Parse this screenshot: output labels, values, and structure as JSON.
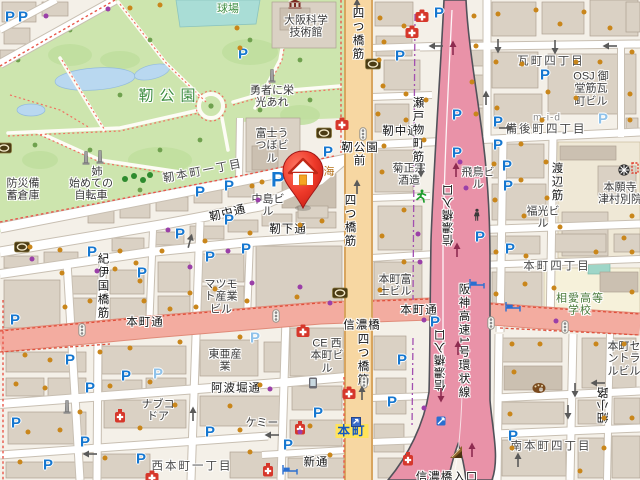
{
  "map": {
    "title": "靭公園周辺地図",
    "marker": {
      "x": 303,
      "y": 182,
      "label": "home"
    },
    "roads": {
      "arterial_ew": "本町通",
      "arterial_ns": "四つ橋筋",
      "expressway": "阪神高速1号環状線",
      "ramp": "信濃橋入口",
      "accent_pink": "#F3ACA0",
      "accent_yellow": "#F7D7A2",
      "accent_expwy": "#E992A8",
      "park_green": "#CDE5AE"
    },
    "labels": [
      {
        "n": "park-name",
        "t": "靭公園",
        "x": 170,
        "y": 97,
        "c": "pk"
      },
      {
        "n": "ballfield-label",
        "t": "球場",
        "x": 228,
        "y": 9,
        "c": "gn"
      },
      {
        "n": "museum-label",
        "t": "大阪科学\n技術館",
        "x": 306,
        "y": 27,
        "c": "bl"
      },
      {
        "n": "monument-label-yusha",
        "t": "勇者に栄\n光あれ",
        "x": 272,
        "y": 97,
        "c": "bl"
      },
      {
        "n": "monument-label-ane",
        "t": "姉",
        "x": 97,
        "y": 172,
        "c": "bl"
      },
      {
        "n": "monument-label-jitensha",
        "t": "始めての\n自転車",
        "x": 91,
        "y": 190,
        "c": "bl"
      },
      {
        "n": "bosai-label",
        "t": "防災備\n蓄倉庫",
        "x": 23,
        "y": 190,
        "c": "bl"
      },
      {
        "n": "district-utsubohonmachi",
        "t": "靭本町一丁目",
        "x": 203,
        "y": 172,
        "c": "dt",
        "r": -11
      },
      {
        "n": "bldg-fuji-utsubo",
        "t": "富士う\nつぼビ\nル",
        "x": 272,
        "y": 146,
        "c": "bl"
      },
      {
        "n": "street-utsubo-nakadori-w",
        "t": "靭中通",
        "x": 228,
        "y": 214,
        "c": "st",
        "r": -14
      },
      {
        "n": "street-utsubo-nakadori-e",
        "t": "靭中通",
        "x": 401,
        "y": 132,
        "c": "st"
      },
      {
        "n": "bldg-nakajima",
        "t": "中島ビ\nル",
        "x": 268,
        "y": 206,
        "c": "bl"
      },
      {
        "n": "street-utsubo-shimodori",
        "t": "靭下通",
        "x": 288,
        "y": 230,
        "c": "st"
      },
      {
        "n": "poi-partial-umi",
        "t": "海",
        "x": 329,
        "y": 172,
        "c": "or"
      },
      {
        "n": "intersection-utsubokoenmae",
        "t": "靭公園\n前",
        "x": 360,
        "y": 155,
        "c": "st"
      },
      {
        "n": "street-yotsubashisuji-top",
        "t": "四つ橋筋",
        "x": 357,
        "y": 34,
        "c": "st vert"
      },
      {
        "n": "street-yotsubashisuji-mid",
        "t": "四つ橋筋",
        "x": 349,
        "y": 221,
        "c": "st vert"
      },
      {
        "n": "street-yotsubashisuji-bot",
        "t": "四つ橋筋",
        "x": 362,
        "y": 360,
        "c": "st vert"
      },
      {
        "n": "bldg-matsumoto",
        "t": "マツモ\nト産業\nビル",
        "x": 221,
        "y": 297,
        "c": "bl"
      },
      {
        "n": "street-honmachidori-w",
        "t": "本町通",
        "x": 145,
        "y": 323,
        "c": "st"
      },
      {
        "n": "street-honmachidori-e",
        "t": "本町通",
        "x": 419,
        "y": 311,
        "c": "st"
      },
      {
        "n": "street-kiinokunibashisuji",
        "t": "紀伊国橋筋",
        "x": 102,
        "y": 286,
        "c": "st vert"
      },
      {
        "n": "bldg-toa",
        "t": "東亜産\n業",
        "x": 225,
        "y": 361,
        "c": "bl"
      },
      {
        "n": "street-awahoridori",
        "t": "阿波堀通",
        "x": 236,
        "y": 389,
        "c": "st"
      },
      {
        "n": "bldg-nabco",
        "t": "ナブコ\nドア",
        "x": 158,
        "y": 411,
        "c": "bl"
      },
      {
        "n": "bldg-chemi",
        "t": "ケミー",
        "x": 262,
        "y": 423,
        "c": "bl"
      },
      {
        "n": "district-nishihonmachi",
        "t": "西本町一丁目",
        "x": 192,
        "y": 467,
        "c": "dt"
      },
      {
        "n": "street-shintori",
        "t": "新通",
        "x": 316,
        "y": 463,
        "c": "st"
      },
      {
        "n": "bldg-kikumasamune",
        "t": "菊正宗\n酒造",
        "x": 409,
        "y": 175,
        "c": "bl"
      },
      {
        "n": "street-setomonocho-suji",
        "t": "瀬戸物町筋",
        "x": 417,
        "y": 130,
        "c": "st vert"
      },
      {
        "n": "bldg-asuka",
        "t": "飛鳥ビ\nル",
        "x": 478,
        "y": 179,
        "c": "bl"
      },
      {
        "n": "bldg-fukumitsu",
        "t": "福光ビ\nル",
        "x": 543,
        "y": 218,
        "c": "bl"
      },
      {
        "n": "district-kawaramachi",
        "t": "瓦町四丁目",
        "x": 551,
        "y": 62,
        "c": "dt"
      },
      {
        "n": "bldg-osj-midosuji",
        "t": "OSJ 御\n堂筋瓦\n町ビル",
        "x": 591,
        "y": 89,
        "c": "bl"
      },
      {
        "n": "bldg-mid",
        "t": "m-i-d",
        "x": 547,
        "y": 118,
        "c": "gy"
      },
      {
        "n": "district-bingomachi",
        "t": "備後町四丁目",
        "x": 546,
        "y": 130,
        "c": "dt"
      },
      {
        "n": "street-watanabesuji",
        "t": "渡辺筋",
        "x": 556,
        "y": 182,
        "c": "st vert"
      },
      {
        "n": "poi-honganji",
        "t": "本願寺\n津村別院",
        "x": 620,
        "y": 194,
        "c": "bl"
      },
      {
        "n": "district-honmachi4",
        "t": "本町四丁目",
        "x": 557,
        "y": 267,
        "c": "dt"
      },
      {
        "n": "school-soai",
        "t": "相愛高等\n学校",
        "x": 580,
        "y": 305,
        "c": "sc"
      },
      {
        "n": "intersection-shinanobashi",
        "t": "信濃橋",
        "x": 362,
        "y": 326,
        "c": "st"
      },
      {
        "n": "bldg-ce-nishihonmachi",
        "t": "CE 西\n本町ビ\nル",
        "x": 327,
        "y": 356,
        "c": "bl"
      },
      {
        "n": "bldg-honmachi-fuji",
        "t": "本町富\n士ビル",
        "x": 395,
        "y": 286,
        "c": "bl"
      },
      {
        "n": "expwy-hanshin-loop",
        "t": "阪神高速1号環状線",
        "x": 463,
        "y": 341,
        "c": "st vert"
      },
      {
        "n": "ramp-shinanobashi-1",
        "t": "信濃橋入口",
        "x": 449,
        "y": 215,
        "c": "st vrev"
      },
      {
        "n": "ramp-shinanobashi-2",
        "t": "信濃橋入口",
        "x": 441,
        "y": 360,
        "c": "st vrev"
      },
      {
        "n": "ramp-shinanobashi-3",
        "t": "信濃橋入口",
        "x": 447,
        "y": 478,
        "c": "st"
      },
      {
        "n": "station-honmachi",
        "t": "本町",
        "x": 352,
        "y": 431,
        "c": "sta"
      },
      {
        "n": "bldg-honmachi-central",
        "t": "本町セ\nントラ\nルビル",
        "x": 624,
        "y": 359,
        "c": "bl"
      },
      {
        "n": "district-minamihonmachi",
        "t": "南本町四丁目",
        "x": 551,
        "y": 447,
        "c": "dt"
      },
      {
        "n": "lane-hosokoji",
        "t": "細小路",
        "x": 604,
        "y": 405,
        "c": "st vrev"
      }
    ],
    "icons": {
      "parking": [
        [
          10,
          17
        ],
        [
          23,
          17
        ],
        [
          243,
          54
        ],
        [
          400,
          56
        ],
        [
          439,
          13
        ],
        [
          545,
          75
        ],
        [
          457,
          115
        ],
        [
          457,
          153
        ],
        [
          498,
          122
        ],
        [
          498,
          145
        ],
        [
          507,
          166
        ],
        [
          508,
          186
        ],
        [
          480,
          237
        ],
        [
          510,
          249
        ],
        [
          229,
          220
        ],
        [
          246,
          249
        ],
        [
          210,
          257
        ],
        [
          180,
          234
        ],
        [
          200,
          192
        ],
        [
          229,
          186
        ],
        [
          328,
          152
        ],
        [
          92,
          252
        ],
        [
          142,
          273
        ],
        [
          15,
          320
        ],
        [
          70,
          360
        ],
        [
          90,
          388
        ],
        [
          126,
          376
        ],
        [
          85,
          442
        ],
        [
          16,
          423
        ],
        [
          48,
          465
        ],
        [
          141,
          459
        ],
        [
          210,
          432
        ],
        [
          318,
          413
        ],
        [
          288,
          445
        ],
        [
          402,
          360
        ],
        [
          392,
          402
        ],
        [
          435,
          322
        ],
        [
          513,
          436
        ]
      ],
      "parking_light": [
        [
          603,
          119
        ],
        [
          158,
          374
        ],
        [
          255,
          338
        ]
      ],
      "parking_big": [
        [
          278,
          180
        ]
      ],
      "hospital": [
        [
          422,
          16
        ],
        [
          412,
          32
        ],
        [
          342,
          124
        ],
        [
          303,
          331
        ],
        [
          349,
          393
        ],
        [
          152,
          477
        ]
      ],
      "pharmacy": [
        [
          300,
          428
        ],
        [
          408,
          459
        ],
        [
          268,
          470
        ],
        [
          120,
          416
        ]
      ],
      "bank": [
        [
          22,
          247
        ],
        [
          324,
          133
        ],
        [
          373,
          64
        ],
        [
          340,
          293
        ],
        [
          4,
          148
        ]
      ],
      "monument": [
        [
          272,
          76
        ],
        [
          86,
          158
        ],
        [
          100,
          157
        ],
        [
          67,
          407
        ]
      ],
      "signal": [
        [
          82,
          330
        ],
        [
          276,
          316
        ],
        [
          491,
          323
        ],
        [
          565,
          327
        ],
        [
          363,
          134
        ],
        [
          364,
          382
        ]
      ],
      "bed": [
        [
          477,
          284
        ],
        [
          513,
          307
        ],
        [
          290,
          470
        ]
      ],
      "subway": [
        [
          356,
          422
        ]
      ],
      "temple": [
        [
          624,
          170
        ]
      ],
      "palette": [
        [
          539,
          388
        ]
      ],
      "runner": [
        [
          421,
          196
        ]
      ],
      "person": [
        [
          477,
          215
        ]
      ],
      "phone": [
        [
          313,
          383
        ]
      ],
      "bike": [
        [
          441,
          421
        ]
      ],
      "slope": [
        [
          456,
          452
        ]
      ],
      "museum": [
        [
          295,
          4
        ]
      ],
      "redsq": [
        [
          635,
          168
        ]
      ]
    },
    "arrows_gray": [
      {
        "x": 436,
        "y": 46,
        "a": 180
      },
      {
        "x": 555,
        "y": 47,
        "a": 90
      },
      {
        "x": 610,
        "y": 46,
        "a": 180
      },
      {
        "x": 486,
        "y": 98,
        "a": -90
      },
      {
        "x": 498,
        "y": 46,
        "a": 90
      },
      {
        "x": 506,
        "y": 128,
        "a": 0
      },
      {
        "x": 190,
        "y": 241,
        "a": -75
      },
      {
        "x": 193,
        "y": 414,
        "a": -90
      },
      {
        "x": 90,
        "y": 454,
        "a": 180
      },
      {
        "x": 272,
        "y": 435,
        "a": 180
      },
      {
        "x": 568,
        "y": 412,
        "a": 90
      },
      {
        "x": 598,
        "y": 383,
        "a": 180
      },
      {
        "x": 518,
        "y": 460,
        "a": -90
      },
      {
        "x": 357,
        "y": 6,
        "a": -90
      },
      {
        "x": 357,
        "y": 187,
        "a": -90
      },
      {
        "x": 362,
        "y": 393,
        "a": -90
      },
      {
        "x": 421,
        "y": 170,
        "a": 90
      },
      {
        "x": 575,
        "y": 390,
        "a": 90
      }
    ],
    "arrows_red": [
      {
        "x": 453,
        "y": 48,
        "a": -90
      },
      {
        "x": 456,
        "y": 170,
        "a": -90
      },
      {
        "x": 457,
        "y": 250,
        "a": -90
      },
      {
        "x": 458,
        "y": 348,
        "a": -90
      },
      {
        "x": 472,
        "y": 450,
        "a": -90
      },
      {
        "x": 441,
        "y": 395,
        "a": 90
      }
    ],
    "dots_orange": [
      [
        237,
        28
      ],
      [
        240,
        48
      ],
      [
        160,
        5
      ],
      [
        130,
        8
      ],
      [
        380,
        18
      ],
      [
        384,
        42
      ],
      [
        404,
        26
      ],
      [
        379,
        60
      ],
      [
        383,
        86
      ],
      [
        406,
        94
      ],
      [
        378,
        114
      ],
      [
        406,
        120
      ],
      [
        474,
        16
      ],
      [
        476,
        46
      ],
      [
        472,
        82
      ],
      [
        476,
        114
      ],
      [
        498,
        14
      ],
      [
        536,
        10
      ],
      [
        560,
        24
      ],
      [
        584,
        12
      ],
      [
        610,
        28
      ],
      [
        632,
        52
      ],
      [
        576,
        62
      ],
      [
        600,
        62
      ],
      [
        496,
        62
      ],
      [
        522,
        64
      ],
      [
        548,
        92
      ],
      [
        576,
        98
      ],
      [
        630,
        94
      ],
      [
        497,
        108
      ],
      [
        542,
        120
      ],
      [
        630,
        120
      ],
      [
        521,
        144
      ],
      [
        546,
        162
      ],
      [
        494,
        164
      ],
      [
        521,
        180
      ],
      [
        547,
        198
      ],
      [
        495,
        200
      ],
      [
        524,
        216
      ],
      [
        632,
        216
      ],
      [
        560,
        227
      ],
      [
        624,
        238
      ],
      [
        496,
        252
      ],
      [
        526,
        256
      ],
      [
        596,
        252
      ],
      [
        632,
        252
      ],
      [
        525,
        284
      ],
      [
        554,
        288
      ],
      [
        496,
        294
      ],
      [
        632,
        292
      ],
      [
        512,
        344
      ],
      [
        540,
        344
      ],
      [
        514,
        372
      ],
      [
        596,
        344
      ],
      [
        624,
        344
      ],
      [
        510,
        414
      ],
      [
        604,
        418
      ],
      [
        632,
        418
      ],
      [
        512,
        448
      ],
      [
        604,
        448
      ],
      [
        580,
        471
      ],
      [
        60,
        250
      ],
      [
        30,
        247
      ],
      [
        120,
        251
      ],
      [
        136,
        263
      ],
      [
        162,
        251
      ],
      [
        205,
        241
      ],
      [
        250,
        233
      ],
      [
        300,
        225
      ],
      [
        322,
        221
      ],
      [
        115,
        269
      ],
      [
        140,
        281
      ],
      [
        190,
        293
      ],
      [
        215,
        289
      ],
      [
        62,
        273
      ],
      [
        90,
        301
      ],
      [
        65,
        307
      ],
      [
        144,
        301
      ],
      [
        170,
        309
      ],
      [
        196,
        307
      ],
      [
        247,
        301
      ],
      [
        297,
        297
      ],
      [
        25,
        355
      ],
      [
        50,
        360
      ],
      [
        100,
        352
      ],
      [
        130,
        348
      ],
      [
        180,
        342
      ],
      [
        240,
        337
      ],
      [
        16,
        384
      ],
      [
        45,
        388
      ],
      [
        110,
        386
      ],
      [
        150,
        382
      ],
      [
        260,
        385
      ],
      [
        230,
        406
      ],
      [
        80,
        412
      ],
      [
        175,
        405
      ],
      [
        28,
        432
      ],
      [
        60,
        430
      ],
      [
        140,
        428
      ],
      [
        240,
        430
      ],
      [
        310,
        426
      ],
      [
        20,
        462
      ],
      [
        105,
        458
      ],
      [
        250,
        452
      ],
      [
        330,
        455
      ],
      [
        252,
        186
      ],
      [
        262,
        182
      ],
      [
        384,
        146
      ],
      [
        382,
        172
      ],
      [
        404,
        210
      ],
      [
        382,
        236
      ],
      [
        404,
        262
      ],
      [
        380,
        290
      ],
      [
        424,
        140
      ],
      [
        426,
        100
      ]
    ],
    "dots_purple": [
      [
        108,
        9
      ],
      [
        46,
        16
      ],
      [
        228,
        251
      ],
      [
        190,
        267
      ],
      [
        252,
        283
      ],
      [
        97,
        271
      ],
      [
        32,
        259
      ],
      [
        300,
        287
      ],
      [
        460,
        162
      ],
      [
        466,
        188
      ],
      [
        418,
        234
      ],
      [
        420,
        262
      ],
      [
        330,
        303
      ],
      [
        424,
        320
      ],
      [
        270,
        389
      ],
      [
        300,
        432
      ],
      [
        424,
        408
      ],
      [
        556,
        321
      ],
      [
        258,
        200
      ],
      [
        168,
        230
      ]
    ]
  }
}
